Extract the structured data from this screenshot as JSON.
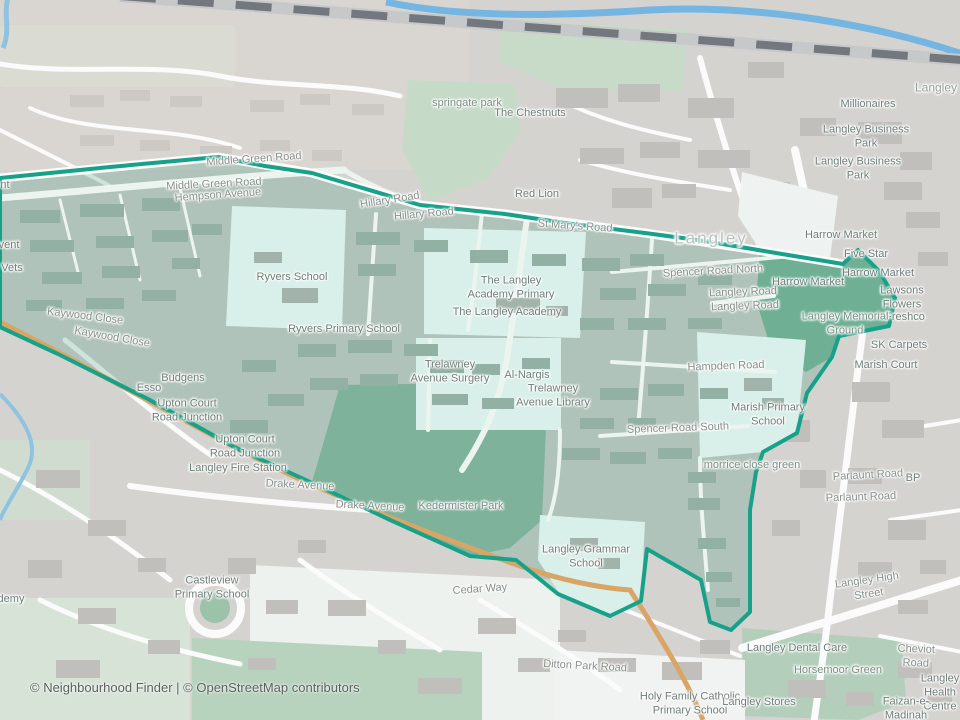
{
  "attribution": "© Neighbourhood Finder | © OpenStreetMap contributors",
  "colors": {
    "boundary": "#18a189",
    "boundary_fill": "rgba(45,140,111,0.22)",
    "water": "#74b5e2",
    "park_inside": "#7fb29a",
    "memorial_green": "#6fb095",
    "school_area": "#d9efe9",
    "background": "#d5d3d0",
    "road_orange": "#d9a567",
    "railway": "#72787d"
  },
  "map_labels": [
    {
      "t": "nt",
      "x": 5,
      "y": 186,
      "c": "poi"
    },
    {
      "t": "vent",
      "x": 9,
      "y": 246,
      "c": "poi"
    },
    {
      "t": "Vets",
      "x": 12,
      "y": 269,
      "c": "poi"
    },
    {
      "t": "demy",
      "x": 11,
      "y": 600,
      "c": "poi"
    },
    {
      "t": "Hempson Avenue",
      "x": 218,
      "y": 196,
      "c": "road",
      "r": -4
    },
    {
      "t": "Middle Green Road",
      "x": 254,
      "y": 160,
      "c": "road",
      "r": -4
    },
    {
      "t": "Middle Green Road",
      "x": 214,
      "y": 185,
      "c": "road",
      "r": -3
    },
    {
      "t": "Hillary Road",
      "x": 390,
      "y": 201,
      "c": "road",
      "r": -9
    },
    {
      "t": "Hillary Road",
      "x": 424,
      "y": 215,
      "c": "road",
      "r": -5
    },
    {
      "t": "St Mary's Road",
      "x": 575,
      "y": 227,
      "c": "road",
      "r": 4
    },
    {
      "t": "Red Lion",
      "x": 537,
      "y": 195,
      "c": "poi"
    },
    {
      "t": "springate park",
      "x": 467,
      "y": 104,
      "c": "area"
    },
    {
      "t": "The Chestnuts",
      "x": 530,
      "y": 114,
      "c": "poi"
    },
    {
      "t": "Langley",
      "x": 936,
      "y": 88,
      "c": "place-sm"
    },
    {
      "t": "Millionaires",
      "x": 868,
      "y": 105,
      "c": "poi"
    },
    {
      "t": "Langley Business Park",
      "x": 866,
      "y": 137,
      "c": "poi"
    },
    {
      "t": "Langley Business Park",
      "x": 858,
      "y": 169,
      "c": "poi"
    },
    {
      "t": "Langley",
      "x": 711,
      "y": 238,
      "c": "place"
    },
    {
      "t": "Harrow Market",
      "x": 841,
      "y": 236,
      "c": "poi"
    },
    {
      "t": "Five Star",
      "x": 866,
      "y": 255,
      "c": "poi"
    },
    {
      "t": "Harrow Market",
      "x": 878,
      "y": 274,
      "c": "poi"
    },
    {
      "t": "Harrow Market",
      "x": 808,
      "y": 283,
      "c": "poi"
    },
    {
      "t": "Lawsons Flowers",
      "x": 902,
      "y": 298,
      "c": "poi"
    },
    {
      "t": "Freshco",
      "x": 905,
      "y": 318,
      "c": "poi"
    },
    {
      "t": "SK Carpets",
      "x": 899,
      "y": 346,
      "c": "poi"
    },
    {
      "t": "Marish Court",
      "x": 886,
      "y": 366,
      "c": "poi"
    },
    {
      "t": "Langley Memorial\nGround",
      "x": 845,
      "y": 324,
      "c": "area"
    },
    {
      "t": "Spencer Road North",
      "x": 713,
      "y": 272,
      "c": "road",
      "r": -3
    },
    {
      "t": "Langley Road",
      "x": 743,
      "y": 293,
      "c": "road",
      "r": -2
    },
    {
      "t": "Langley Road",
      "x": 745,
      "y": 307,
      "c": "road",
      "r": -2
    },
    {
      "t": "Hampden Road",
      "x": 726,
      "y": 367,
      "c": "road",
      "r": -2
    },
    {
      "t": "Marish Primary\nSchool",
      "x": 768,
      "y": 415,
      "c": "poi"
    },
    {
      "t": "Spencer Road South",
      "x": 678,
      "y": 429,
      "c": "road",
      "r": -2
    },
    {
      "t": "morrice close green",
      "x": 752,
      "y": 466,
      "c": "area"
    },
    {
      "t": "Parlaunt Road",
      "x": 868,
      "y": 476,
      "c": "road",
      "r": -3
    },
    {
      "t": "Parlaunt Road",
      "x": 861,
      "y": 498,
      "c": "road",
      "r": -2
    },
    {
      "t": "BP",
      "x": 913,
      "y": 479,
      "c": "poi"
    },
    {
      "t": "Langley High Street",
      "x": 868,
      "y": 588,
      "c": "road",
      "r": -8
    },
    {
      "t": "Ryvers School",
      "x": 292,
      "y": 278,
      "c": "poi"
    },
    {
      "t": "Ryvers Primary School",
      "x": 344,
      "y": 330,
      "c": "poi"
    },
    {
      "t": "The Langley\nAcademy Primary",
      "x": 511,
      "y": 288,
      "c": "poi"
    },
    {
      "t": "The Langley Academy",
      "x": 507,
      "y": 313,
      "c": "poi"
    },
    {
      "t": "Trelawney\nAvenue Surgery",
      "x": 450,
      "y": 372,
      "c": "poi"
    },
    {
      "t": "Al-Nargis",
      "x": 527,
      "y": 376,
      "c": "poi"
    },
    {
      "t": "Trelawney\nAvenue Library",
      "x": 553,
      "y": 396,
      "c": "poi"
    },
    {
      "t": "Kaywood Close",
      "x": 85,
      "y": 317,
      "c": "road",
      "r": 7
    },
    {
      "t": "Kaywood Close",
      "x": 112,
      "y": 338,
      "c": "road",
      "r": 10
    },
    {
      "t": "Budgens",
      "x": 183,
      "y": 379,
      "c": "poi"
    },
    {
      "t": "Esso",
      "x": 149,
      "y": 389,
      "c": "poi"
    },
    {
      "t": "Upton Court\nRoad Junction",
      "x": 187,
      "y": 411,
      "c": "poi"
    },
    {
      "t": "Upton Court\nRoad Junction",
      "x": 245,
      "y": 447,
      "c": "poi"
    },
    {
      "t": "Langley Fire Station",
      "x": 238,
      "y": 469,
      "c": "poi"
    },
    {
      "t": "Drake Avenue",
      "x": 300,
      "y": 486,
      "c": "road",
      "r": 3
    },
    {
      "t": "Drake Avenue",
      "x": 370,
      "y": 507,
      "c": "road",
      "r": 3
    },
    {
      "t": "Kedermister Park",
      "x": 461,
      "y": 507,
      "c": "area"
    },
    {
      "t": "Langley Grammar\nSchool",
      "x": 586,
      "y": 557,
      "c": "poi"
    },
    {
      "t": "Cedar Way",
      "x": 480,
      "y": 590,
      "c": "road",
      "r": -4
    },
    {
      "t": "Castleview\nPrimary School",
      "x": 212,
      "y": 588,
      "c": "poi"
    },
    {
      "t": "Ditton Park Road",
      "x": 585,
      "y": 667,
      "c": "road",
      "r": 3
    },
    {
      "t": "Holy Family Catholic\nPrimary School",
      "x": 690,
      "y": 704,
      "c": "poi"
    },
    {
      "t": "Langley Stores",
      "x": 759,
      "y": 703,
      "c": "poi"
    },
    {
      "t": "Langley Dental Care",
      "x": 797,
      "y": 649,
      "c": "poi"
    },
    {
      "t": "Cheviot Road",
      "x": 916,
      "y": 657,
      "c": "road",
      "r": 2
    },
    {
      "t": "Horsemoor Green",
      "x": 838,
      "y": 671,
      "c": "area"
    },
    {
      "t": "Langley Health Centre",
      "x": 940,
      "y": 693,
      "c": "poi"
    },
    {
      "t": "Faizan-e-Madinah",
      "x": 906,
      "y": 709,
      "c": "poi"
    }
  ]
}
